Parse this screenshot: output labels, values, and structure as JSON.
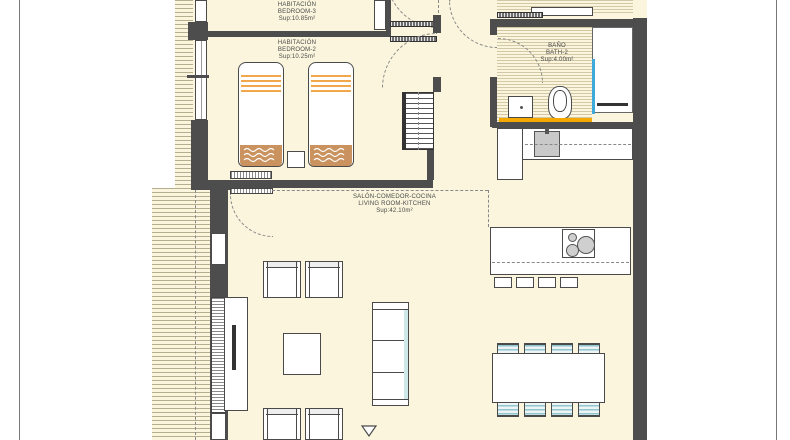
{
  "plan": {
    "rooms": {
      "bedroom3": {
        "name_es": "HABITACIÓN",
        "name_en": "BEDROOM-3",
        "area": "Sup:10.85m²"
      },
      "bedroom2": {
        "name_es": "HABITACIÓN",
        "name_en": "BEDROOM-2",
        "area": "Sup:10.25m²"
      },
      "bath2": {
        "name_es": "BAÑO",
        "name_en": "BATH-2",
        "area": "Sup:4.00m²"
      },
      "living": {
        "name_es": "SALÓN-COMEDOR-COCINA",
        "name_en": "LIVING ROOM-KITCHEN",
        "area": "Sup:42.10m²"
      },
      "hall": {
        "area": "Sup:3.25m²"
      }
    },
    "colors": {
      "page_background": "#FFFFFF",
      "floor": "#FAF5DC",
      "wall": "#4D4D4D",
      "bed_accent_orange": "#F2A74B",
      "blanket_tan": "#C9925E",
      "bath_counter_orange": "#F5A800",
      "chair_stripe_teal": "#8FC6D2",
      "shower_glass_blue": "#3FA9DC"
    }
  }
}
